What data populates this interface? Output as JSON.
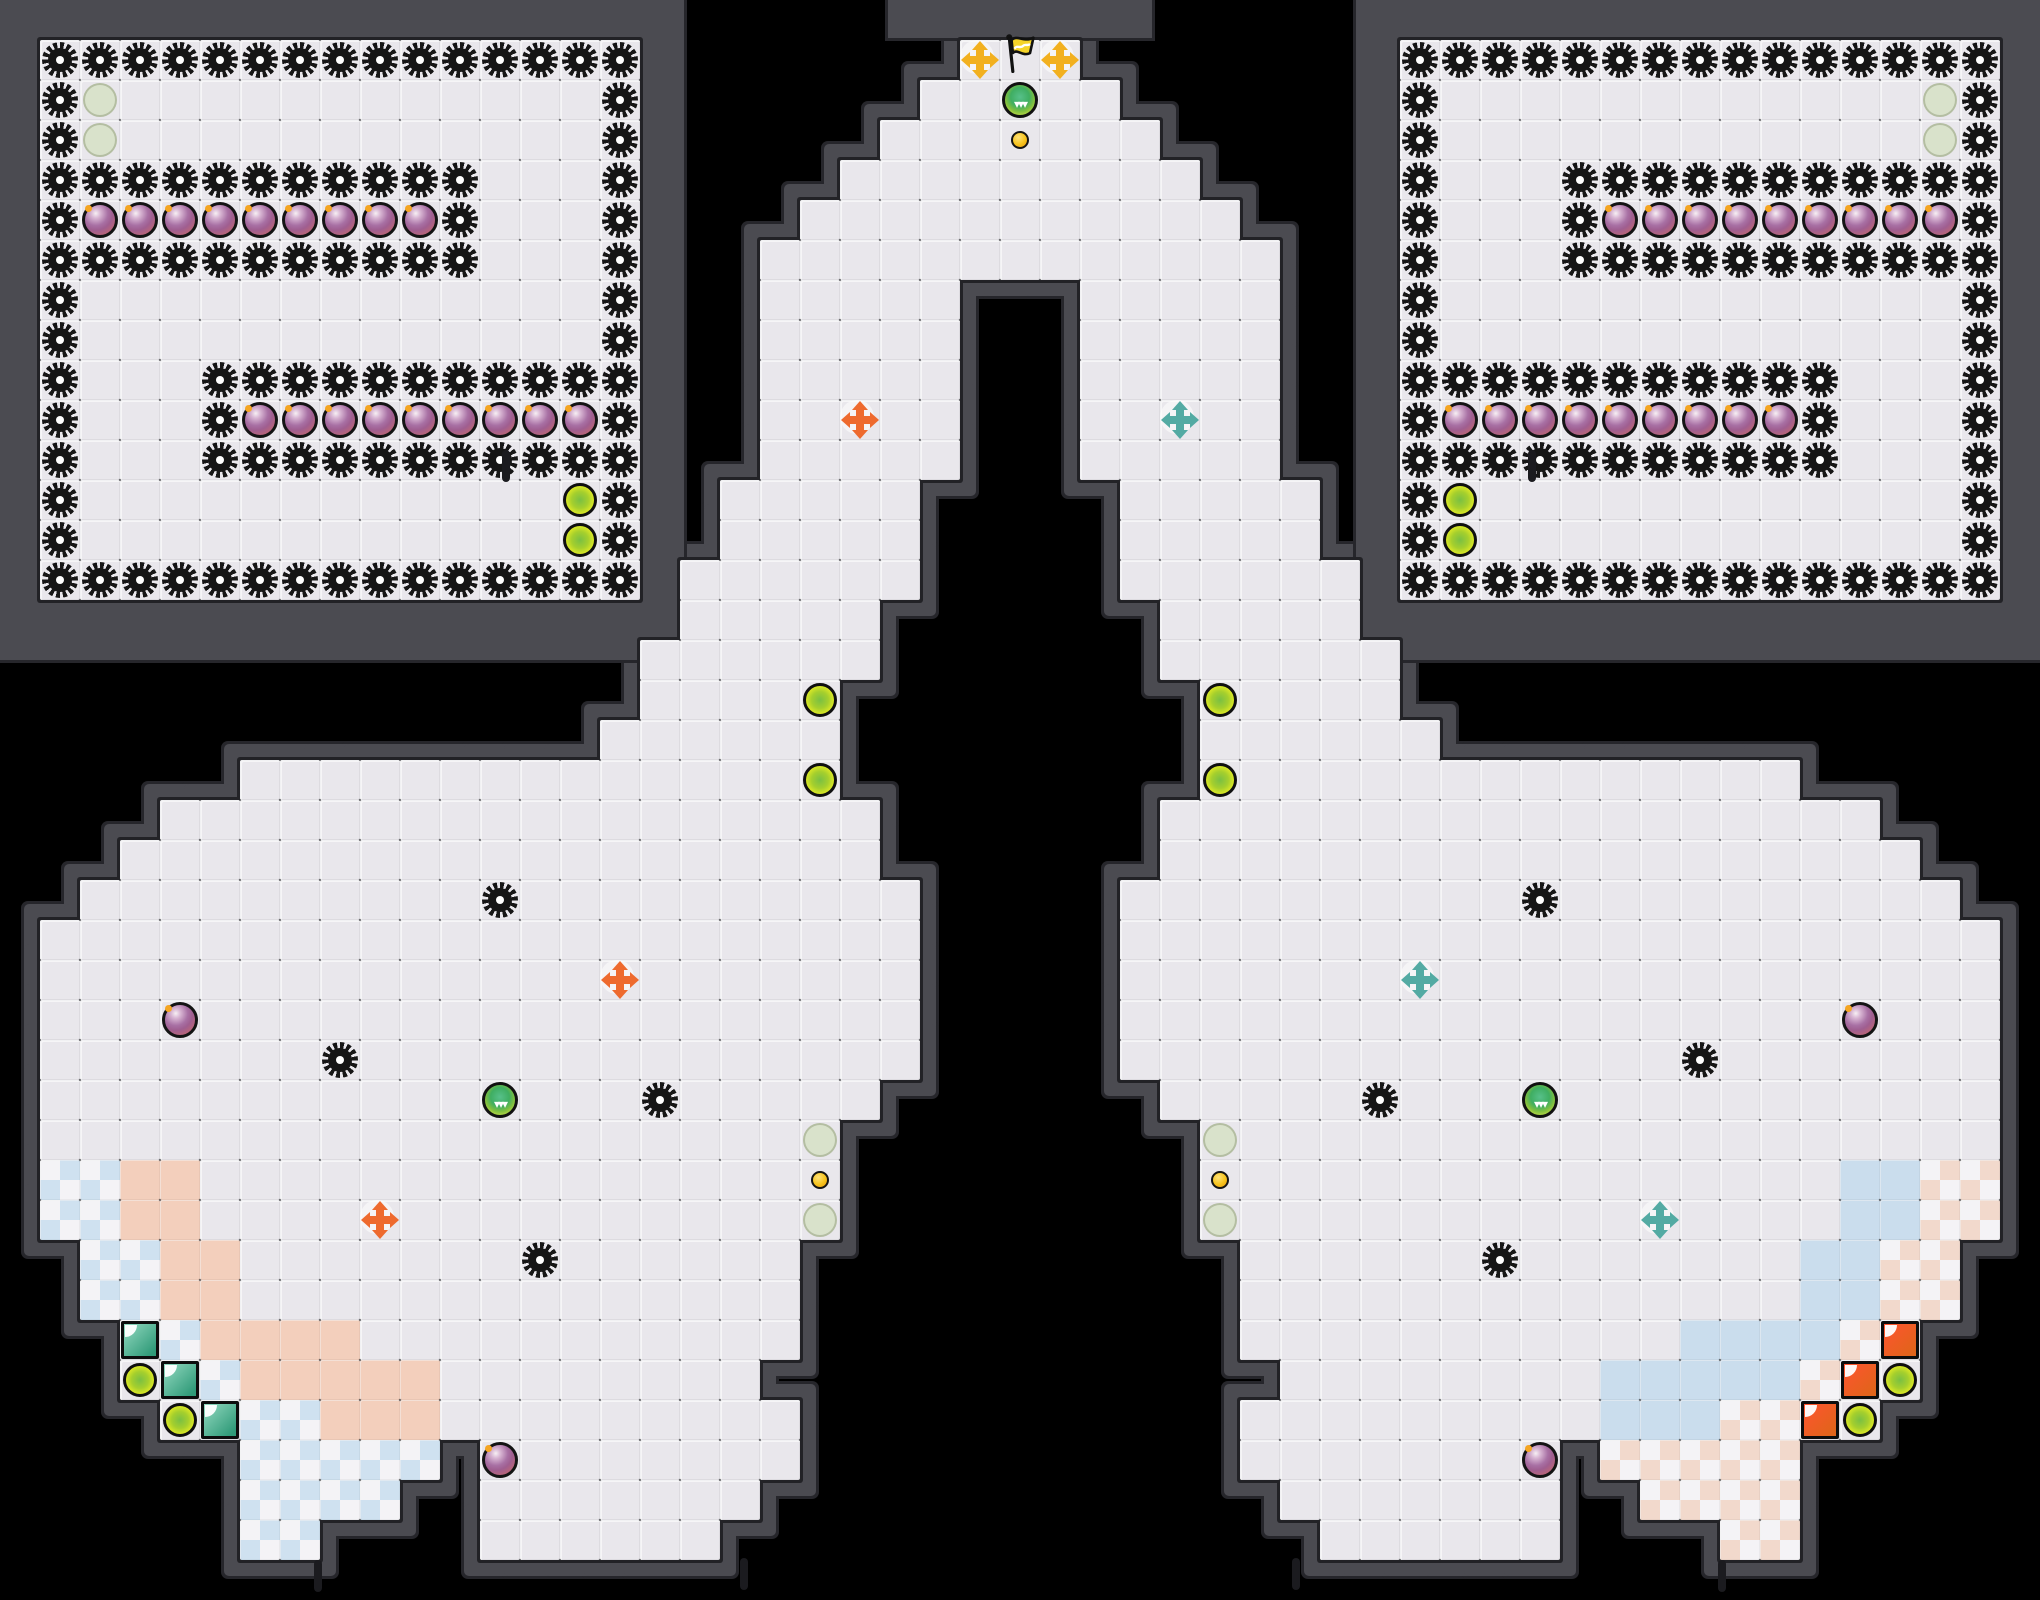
{
  "board": {
    "width": 2040,
    "height": 1600,
    "tile": 40,
    "cols": 51,
    "rows": 40
  },
  "palette": {
    "background": "#000000",
    "wall": "#4b4b51",
    "wall_outline": "#26262b",
    "floor": "#e9e7ec",
    "floor_rim": "#222226",
    "spike": "#161616",
    "bomb_ring": "#141414",
    "bomb_spark": "#f5a623",
    "boost_fill": "#e7ee25",
    "boost_core": "#7ac043",
    "pale_circle": "#d9e2cb",
    "button_gold": "#f6c21c",
    "cross_red": "#ee6a2e",
    "cross_blue": "#53aaa3",
    "cross_yellow": "#f2b01f",
    "flag_yellow": "#f5d429",
    "powerup_green": "#3fae62",
    "powerup_ring_green": "#c6dd46",
    "gate_blue_light": "#93d9c0",
    "gate_blue_dark": "#2f9a78",
    "gate_red_light": "#ff5430",
    "gate_red_dark": "#e0641a",
    "team_red_tile": "#f3cfbc",
    "team_blue_tile": "#cadded",
    "checker_blue": "#cfe1f0",
    "checker_pink": "#f2d9cc",
    "checker_white": "#f4f3f6"
  },
  "glyphs": {
    "powerup_chevrons": "▾▾▾"
  },
  "legend": {
    ".": {
      "name": "floor-tile",
      "interactable": false
    },
    "S": {
      "name": "spike",
      "interactable": false
    },
    "B": {
      "name": "bomb",
      "interactable": true
    },
    "P": {
      "name": "powerup-spawn",
      "interactable": false
    },
    "G": {
      "name": "powerup",
      "interactable": true
    },
    "Y": {
      "name": "boost-pad",
      "interactable": true
    },
    "u": {
      "name": "gate-button",
      "interactable": true
    },
    "O": {
      "name": "red-team-boost",
      "interactable": true
    },
    "T": {
      "name": "blue-team-boost",
      "interactable": true
    },
    "N": {
      "name": "neutral-boost",
      "interactable": true
    },
    "F": {
      "name": "neutral-flag",
      "interactable": true
    },
    "g": {
      "name": "blue-gate",
      "interactable": true
    },
    "r": {
      "name": "red-gate",
      "interactable": true
    },
    "q": {
      "name": "blue-endzone-tile",
      "interactable": false
    },
    "Q": {
      "name": "red-endzone-tile",
      "interactable": false
    },
    "L": {
      "name": "red-team-tile",
      "interactable": false
    },
    "l": {
      "name": "blue-team-tile",
      "interactable": false
    }
  },
  "slabs": [
    {
      "x": 0,
      "y": 0,
      "w": 684,
      "h": 660
    },
    {
      "x": 1356,
      "y": 0,
      "w": 684,
      "h": 660
    },
    {
      "x": 888,
      "y": 0,
      "w": 264,
      "h": 38
    }
  ],
  "ticks": [
    {
      "x": 502,
      "y": 450
    },
    {
      "x": 1528,
      "y": 450
    },
    {
      "x": 314,
      "y": 1560
    },
    {
      "x": 740,
      "y": 1558
    },
    {
      "x": 1292,
      "y": 1558
    },
    {
      "x": 1718,
      "y": 1560
    }
  ],
  "grid": [
    "                                                   ",
    " SSSSSSSSSSSSSSS        NFN        SSSSSSSSSSSSSSS ",
    " SP............S       ..G..       S............PS ",
    " SP............S      ...u...      S............PS ",
    " SSSSSSSSSSS...S     .........     S...SSSSSSSSSSS ",
    " SBBBBBBBBBS...S    ...........    S...SBBBBBBBBBS ",
    " SSSSSSSSSSS...S   .............   S...SSSSSSSSSSS ",
    " S.............S   .....   .....   S.............S ",
    " S.............S   .....   .....   S.............S ",
    " S...SSSSSSSSSSS   .....   .....   SSSSSSSSSSS...S ",
    " S...SBBBBBBBBBS   ..O..   ..T..   SBBBBBBBBBS...S ",
    " S...SSSSSSSSSSS   .....   .....   SSSSSSSSSSS...S ",
    " S............YS  .....     .....  SY............S ",
    " S............YS  .....     .....  SY............S ",
    " SSSSSSSSSSSSSSS ......     ...... SSSSSSSSSSSSSSS ",
    "                 .....       .....                 ",
    "                ......       ......                ",
    "                ....Y         Y....                ",
    "               ......         ......               ",
    "      ..............Y         Y..............      ",
    "    ..................       ..................    ",
    "   ...................       ...................   ",
    "  ..........S..........     ..........S..........  ",
    " ......................     ...................... ",
    " ..............O.......     .......T.............. ",
    " ...B..................     ..................B... ",
    " .......S..............     ..............S....... ",
    " ...........G...S.....       .....S...G........... ",
    " ...................P         P................... ",
    " qqLL...............u         u...............llQQ ",
    " qqLL....O..........P         P..........T....llQQ ",
    "  qqLL.......S......           ......S.......llQQ  ",
    "  qqLL..............           ..............llQQ  ",
    "   gqLLLL...........           ...........llllQr   ",
    "   YgqLLLLL........             ........lllllQrY   ",
    "    YgqqLLL.........           .........lllQQrY    ",
    "      qqqqq B.......           .......B QQQQQ      ",
    "      qqqq  .......             .......  QQQQ      ",
    "      qq    ......               ......    QQ      ",
    "                                                   ",
    "                                                   "
  ]
}
